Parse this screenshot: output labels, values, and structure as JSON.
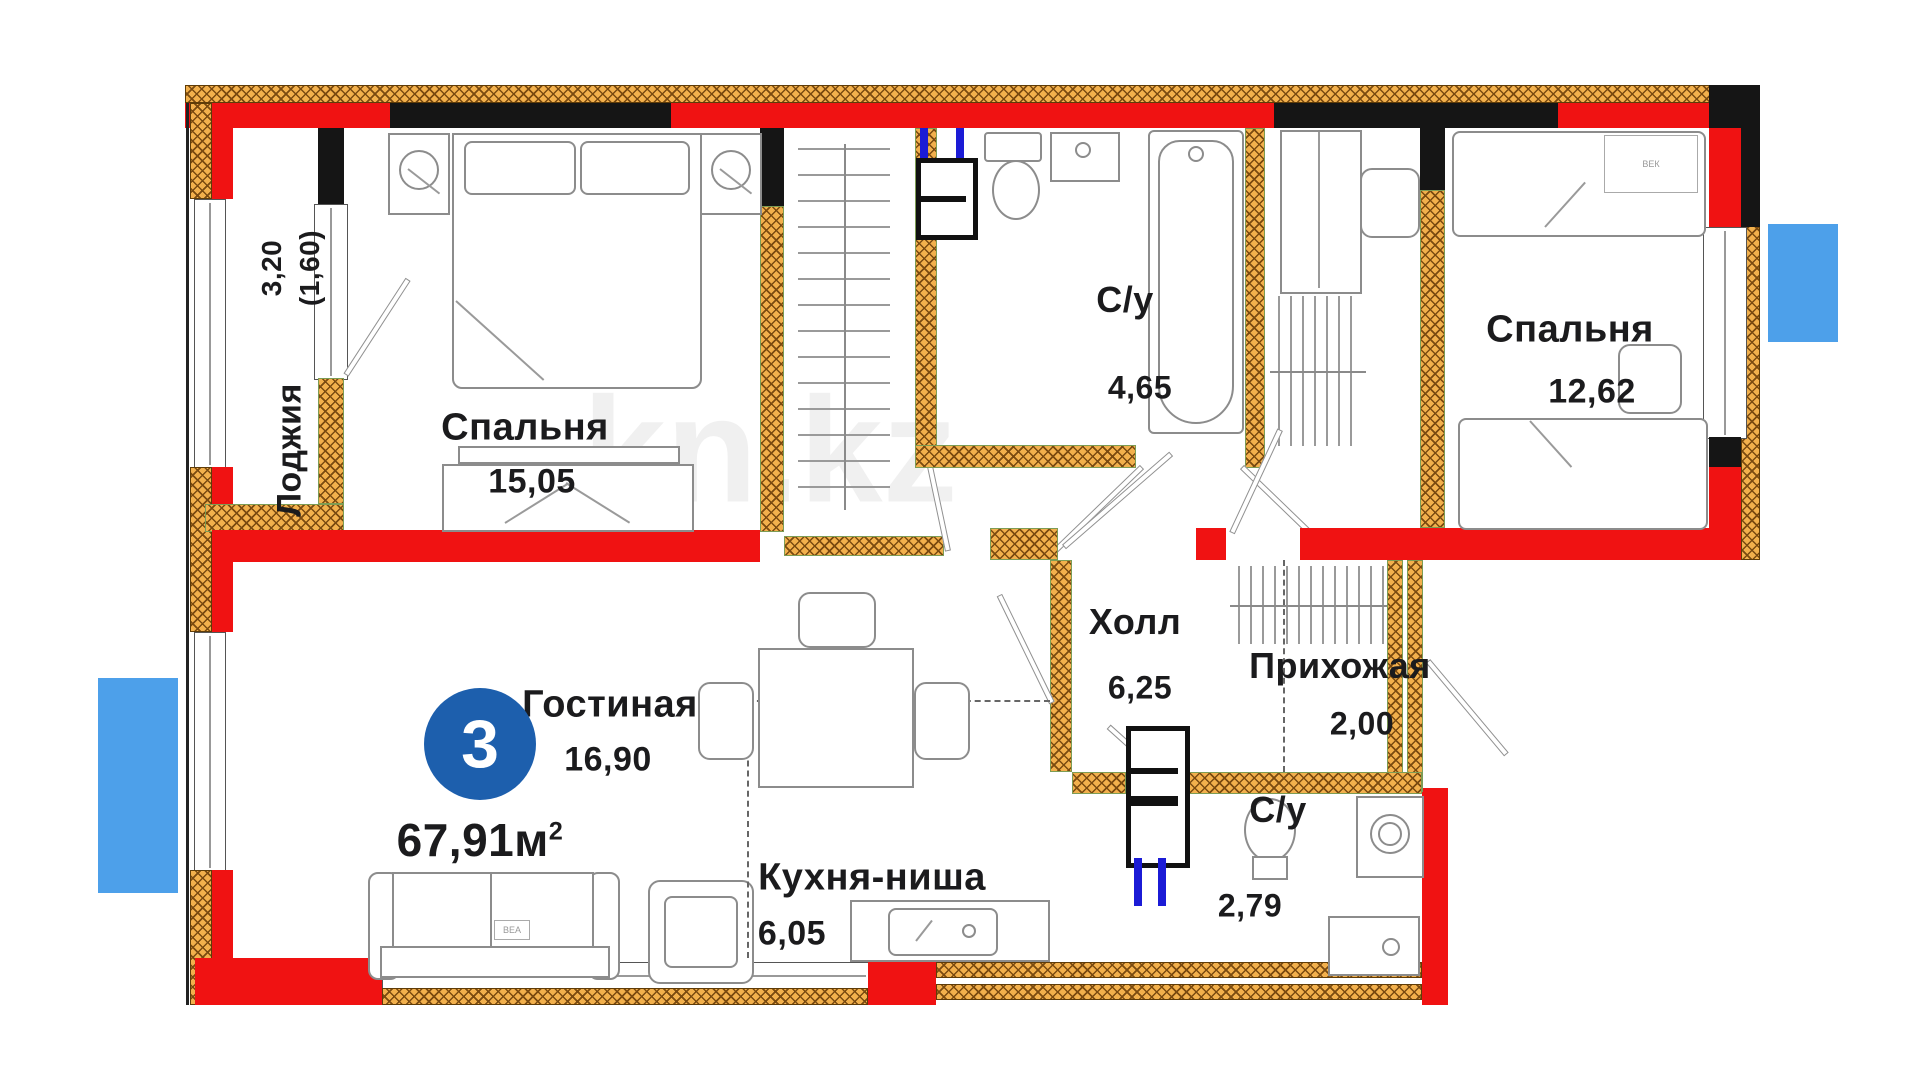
{
  "title": "Floor plan 3-room apartment",
  "badge": {
    "rooms": "3",
    "area_main": "67,91м",
    "area_sup": "2"
  },
  "watermark": {
    "text": "kn.kz"
  },
  "rooms": {
    "loggia": {
      "name": "Лоджия",
      "dim1": "3,20",
      "dim2": "(1,60)"
    },
    "bedroom1": {
      "name": "Спальня",
      "area": "15,05"
    },
    "bath1": {
      "name": "С/у",
      "area": "4,65"
    },
    "bedroom2": {
      "name": "Спальня",
      "area": "12,62"
    },
    "living": {
      "name": "Гостиная",
      "area": "16,90"
    },
    "hall": {
      "name": "Холл",
      "area": "6,25"
    },
    "entry": {
      "name": "Прихожая",
      "area": "2,00"
    },
    "bath2": {
      "name": "С/у",
      "area": "2,79"
    },
    "kitchen": {
      "name": "Кухня-ниша",
      "area": "6,05"
    }
  },
  "furniture_tags": {
    "bed": "ВЕК",
    "sofa": "ВЕА"
  },
  "colors": {
    "wall_red": "#f01212",
    "wall_black": "#151515",
    "hatch_fill": "#f2b04c",
    "hatch_line": "#7a4a10",
    "pipe_blue": "#1b1bd6",
    "balcony_marker_blue": "#4da0ea",
    "badge_blue": "#1d5fad",
    "text_ink": "#1b1b1d"
  }
}
